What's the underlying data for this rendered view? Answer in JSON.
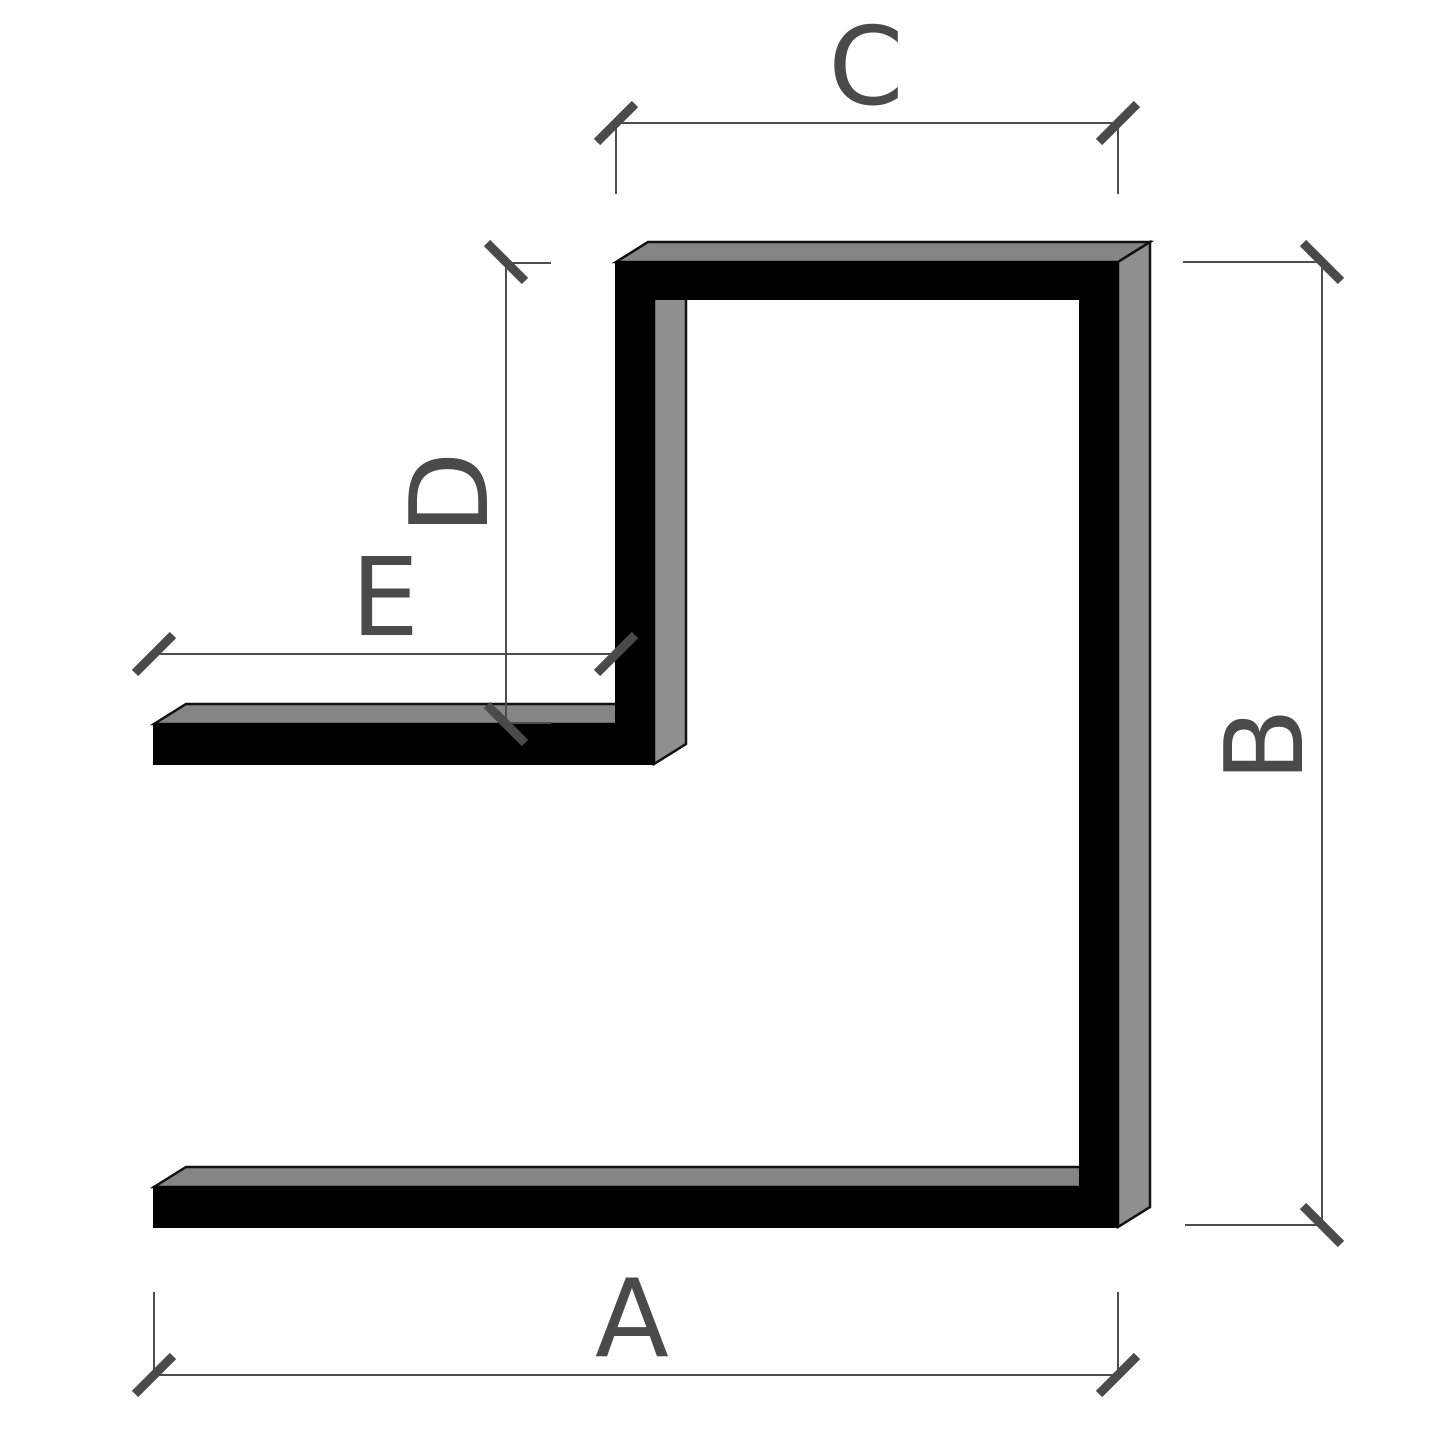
{
  "figure": {
    "type": "technical-dimension-drawing",
    "description": "3D cross-section of an F-shaped extruded profile with five dimension lines",
    "labels": {
      "a": "A",
      "b": "B",
      "c": "C",
      "d": "D",
      "e": "E"
    }
  },
  "colors": {
    "background": "#ffffff",
    "profile_front": "#000000",
    "profile_top_face": "#858585",
    "profile_side_face": "#8f8f8f",
    "edge_outline": "#111111",
    "dimension_line": "#4d4d4d",
    "dimension_tick": "#4a4a4a",
    "label_text": "#4a4a4a"
  }
}
